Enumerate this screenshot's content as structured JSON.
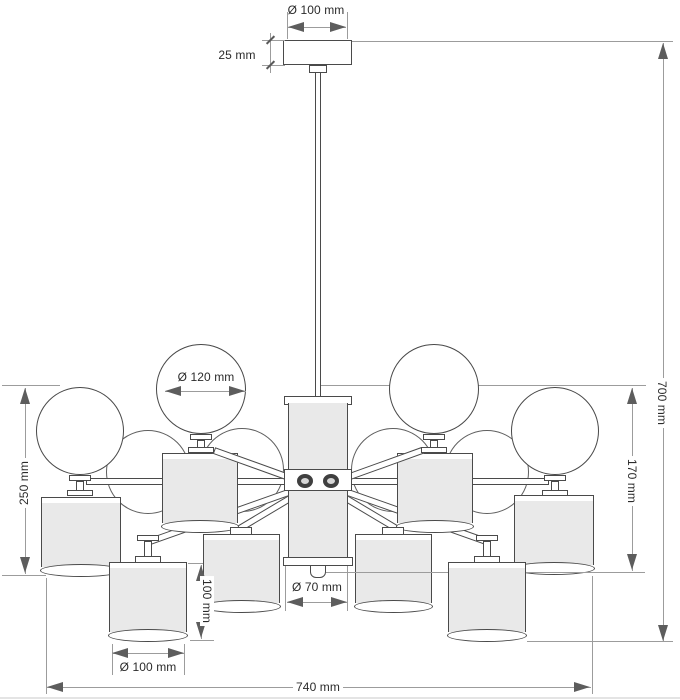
{
  "dimensions": {
    "canopy_diameter": "Ø 100 mm",
    "canopy_height": "25 mm",
    "ball_diameter": "Ø 120 mm",
    "overall_height": "700 mm",
    "upper_section_height": "170 mm",
    "arm_assembly_height": "250 mm",
    "column_diameter": "Ø 70 mm",
    "shade_height": "100 mm",
    "shade_diameter": "Ø 100 mm",
    "overall_width": "740 mm"
  }
}
